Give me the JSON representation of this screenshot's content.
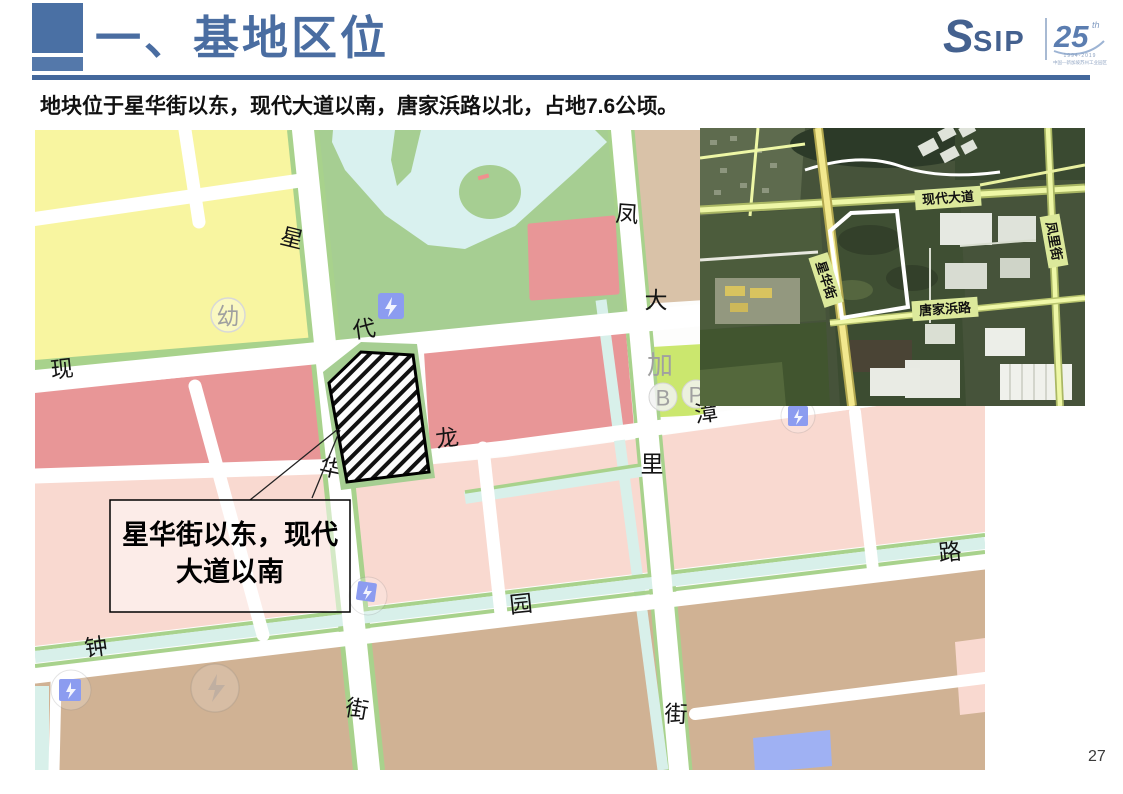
{
  "page": {
    "number": "27"
  },
  "header": {
    "title": "一、基地区位",
    "subtitle": "地块位于星华街以东，现代大道以南，唐家浜路以北，占地7.6公顷。"
  },
  "logo": {
    "sip_glyph": "S",
    "sip_text": "SIP",
    "anniversary_number": "25",
    "anniversary_suffix": "th",
    "anniversary_years": "1994-2019",
    "anniversary_caption": "中国—新加坡苏州工业园区"
  },
  "map": {
    "callout": {
      "line1": "星华街以东，现代",
      "line2": "大道以南"
    },
    "street_labels": [
      {
        "text": "星",
        "x": 257,
        "y": 108,
        "rot": 14
      },
      {
        "text": "代",
        "x": 329,
        "y": 199,
        "rot": -8
      },
      {
        "text": "现",
        "x": 27,
        "y": 239,
        "rot": -6
      },
      {
        "text": "大",
        "x": 621,
        "y": 170,
        "rot": 0
      },
      {
        "text": "凤",
        "x": 592,
        "y": 84,
        "rot": 4
      },
      {
        "text": "龙",
        "x": 412,
        "y": 308,
        "rot": -8
      },
      {
        "text": "里",
        "x": 617,
        "y": 334,
        "rot": 0
      },
      {
        "text": "华",
        "x": 296,
        "y": 338,
        "rot": 12
      },
      {
        "text": "园",
        "x": 486,
        "y": 474,
        "rot": -6
      },
      {
        "text": "钟",
        "x": 61,
        "y": 517,
        "rot": -8
      },
      {
        "text": "路",
        "x": 915,
        "y": 422,
        "rot": -6
      },
      {
        "text": "街",
        "x": 322,
        "y": 579,
        "rot": 10
      },
      {
        "text": "街",
        "x": 641,
        "y": 584,
        "rot": 2
      },
      {
        "text": "漳",
        "x": 671,
        "y": 283,
        "rot": -8
      }
    ],
    "poi_labels": [
      {
        "text": "幼",
        "x": 193,
        "y": 186,
        "size": 23
      },
      {
        "text": "加",
        "x": 625,
        "y": 235,
        "size": 26
      },
      {
        "text": "B",
        "x": 628,
        "y": 268,
        "size": 22
      },
      {
        "text": "P",
        "x": 661,
        "y": 265,
        "size": 22
      }
    ]
  },
  "satellite": {
    "labels": [
      {
        "text": "现代大道",
        "x": 248,
        "y": 70,
        "rot": -4
      },
      {
        "text": "凤里街",
        "x": 354,
        "y": 113,
        "rot": 80
      },
      {
        "text": "星华街",
        "x": 126,
        "y": 152,
        "rot": 72
      },
      {
        "text": "唐家浜路",
        "x": 245,
        "y": 181,
        "rot": -4
      }
    ]
  },
  "colors": {
    "title_blue": "#4a6da1",
    "underline_blue": "#44689c",
    "logo_blue": "#44618f",
    "zone_yellow": "#f8f5a0",
    "zone_green": "#a8d28c",
    "zone_green_bright": "#cbe76e",
    "zone_red": "#e89697",
    "zone_pink": "#f9d9d0",
    "zone_tan": "#d0b294",
    "water_cyan": "#d8f0ea",
    "utility_blue": "#8c9cf0",
    "sat_label_bg": "#dce99b"
  }
}
